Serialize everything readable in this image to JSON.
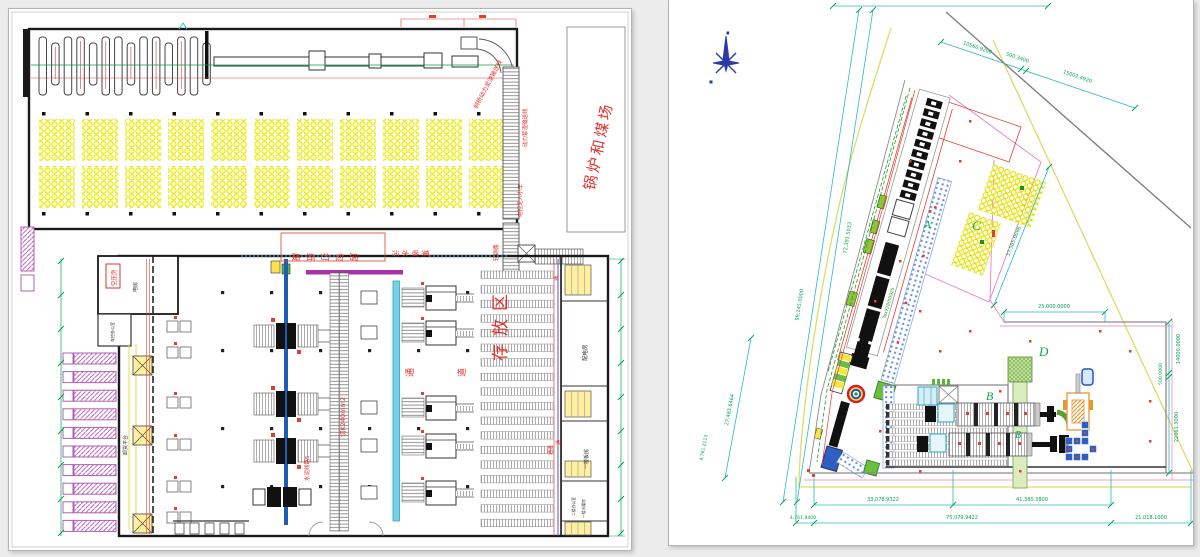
{
  "colors": {
    "red_label": "#e0312e",
    "dim_green": "#00a651",
    "dim_cyan": "#2ab7c9",
    "bale_yellow": "#ffffb0",
    "truck_magenta": "#c06ac0",
    "conveyor_blue": "#1a5fb4",
    "strip_cyan": "#79d2e3",
    "site_boundary_yellow": "#dedc66",
    "parcel_pink": "#e87fc0"
  },
  "left_plan": {
    "coal_yard_label": "锅炉和煤场",
    "labels": {
      "conveyor_top": "斜桥动力浆渣输送线",
      "conveyor_mid": "动力浆渣输送线",
      "cart": "电控无人小车",
      "shed": "轻钢棚",
      "baling_room": "废纸打包房",
      "sewage": "污水收集",
      "storage_area": "存放区",
      "aisle_left": "通",
      "aisle_right": "道",
      "aisle_side": "通道",
      "cable": "切K240mm2",
      "floor_line": "水泥线路5",
      "unloading": "卸货平台",
      "compressor_room": "空压房",
      "power_room": "电房",
      "office": "车控办公室",
      "pass_top": "通",
      "pass_mid": "通"
    },
    "rooms": [
      {
        "name": "配电房"
      },
      {
        "name": "一楼板房"
      },
      {
        "name": "二楼办公室"
      },
      {
        "name": "一楼水暖房"
      }
    ]
  },
  "site_plan": {
    "areas": {
      "a": "A",
      "b": "B",
      "b2": "B",
      "c": "C",
      "d": "D"
    },
    "machine_code": "Tex7280t0925",
    "dims": {
      "top_1": "10560.9200",
      "top_2": "500.3400",
      "top_3": "15002.4920",
      "left_1": "72,391.5033",
      "left_2": "99,145.0000",
      "left_3": "27,483.6464",
      "left_4": "4,761.2113",
      "diag_c": "37,505.0096",
      "notch": "25,000.0000",
      "right_1": "14000.0000",
      "right_2": "500.0000",
      "right_3": "22061.3000",
      "bottom_a": "33,078.9322",
      "bottom_b": "41,380.3800",
      "bottom_c": "4,761.9400",
      "bottom_d": "75,079.9422",
      "bottom_e": "21,018.1000"
    }
  }
}
